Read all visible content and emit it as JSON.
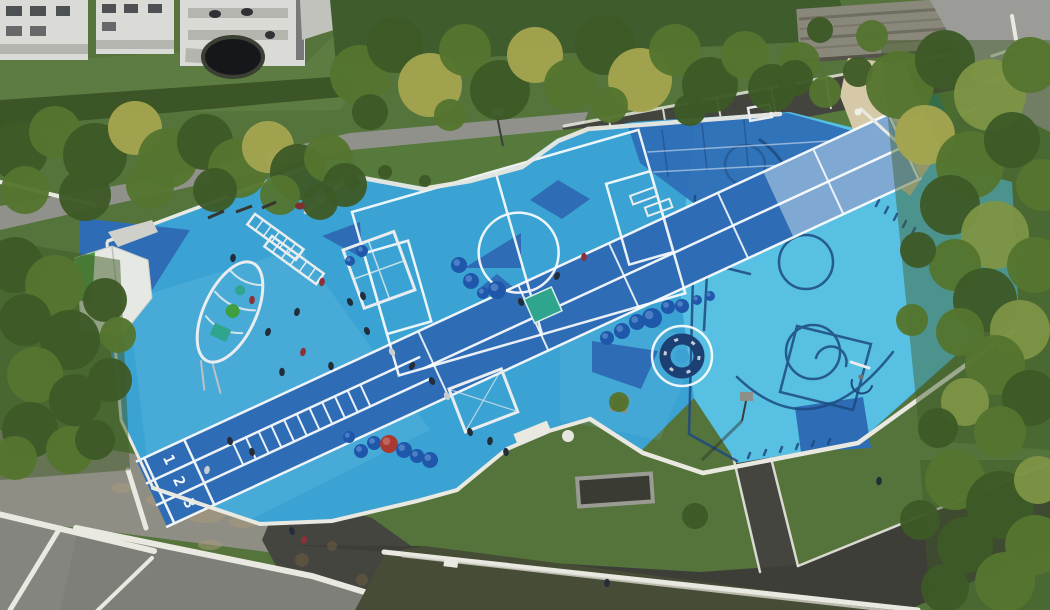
{
  "image": {
    "type": "aerial-drone-photo",
    "subject": "Blue multi-sport playground park seen from above: running track, ball courts, climbing equipment, surrounded by trees, paths and rooftops"
  },
  "palette": {
    "courtBlue": "#3ba3d3",
    "courtCyan": "#58c0e2",
    "lightOverlay": "#72c6e8",
    "royal": "#2e6cb5",
    "navy": "#1d4a80",
    "parapet": "#eae9e1",
    "equip": "#e9edef",
    "grassBase": "#55743c",
    "grassLight": "#5d7c42",
    "grassDark": "#3f5c2c",
    "hedge": "#3b5526",
    "tree_dark": "#3d5a26",
    "tree_mid": "#54752f",
    "tree_light": "#7d9445",
    "tree_yellow": "#a3a44f",
    "path": "#90918a",
    "road": "#9b9c97",
    "parking": "#43443e",
    "asphalt": "#45453f",
    "asphalt2": "#3e3e39",
    "concrete": "#8f8e85",
    "roof": "#84857e",
    "sedum": "#474c36",
    "sand": "#d6c9a8",
    "stone": "#8a887b",
    "dome": "#1f57aa",
    "domeRed": "#a83a33",
    "mat": "#2ea58c",
    "building": "#dadad6",
    "balcony": "#b5b5af",
    "window": "#35383c",
    "people_dark": "#232d3a",
    "people_red": "#8e3038",
    "people_grey": "#c9cdd0",
    "carousel": "#1c3f74",
    "stain": "#ab9a7c",
    "spot": "#6b5b40",
    "trampoline": "#15171a"
  },
  "track": {
    "lane_numbers": [
      "1",
      "2",
      "3"
    ],
    "ladder_x": [
      95,
      109,
      123,
      137,
      151,
      165,
      179,
      193,
      207,
      221,
      235
    ],
    "cross_x": [
      310,
      420,
      520,
      640,
      745
    ]
  },
  "fence": {
    "x1": 104,
    "y1": 234,
    "x2": 572,
    "y2": 150,
    "count": 17
  },
  "parking_stripes": [
    [
      609,
      119,
      614,
      149
    ],
    [
      663,
      109,
      668,
      139
    ],
    [
      717,
      99,
      723,
      129
    ],
    [
      771,
      89,
      777,
      119
    ],
    [
      826,
      79,
      831,
      109
    ],
    [
      880,
      69,
      886,
      98
    ]
  ],
  "trees": [
    [
      18,
      150,
      30,
      "dark"
    ],
    [
      55,
      132,
      26,
      "mid"
    ],
    [
      95,
      155,
      32,
      "dark"
    ],
    [
      135,
      128,
      27,
      "yellow"
    ],
    [
      168,
      158,
      30,
      "mid"
    ],
    [
      205,
      142,
      28,
      "dark"
    ],
    [
      238,
      168,
      30,
      "mid"
    ],
    [
      268,
      147,
      26,
      "yellow"
    ],
    [
      298,
      172,
      28,
      "dark"
    ],
    [
      328,
      158,
      24,
      "mid"
    ],
    [
      345,
      185,
      22,
      "dark"
    ],
    [
      25,
      190,
      24,
      "mid"
    ],
    [
      85,
      195,
      26,
      "dark"
    ],
    [
      150,
      185,
      24,
      "mid"
    ],
    [
      215,
      190,
      22,
      "dark"
    ],
    [
      280,
      195,
      20,
      "mid"
    ],
    [
      320,
      202,
      18,
      "dark"
    ],
    [
      360,
      75,
      30,
      "mid"
    ],
    [
      395,
      45,
      28,
      "dark"
    ],
    [
      430,
      85,
      32,
      "yellow"
    ],
    [
      465,
      50,
      26,
      "mid"
    ],
    [
      500,
      90,
      30,
      "dark"
    ],
    [
      535,
      55,
      28,
      "yellow"
    ],
    [
      570,
      85,
      26,
      "mid"
    ],
    [
      605,
      45,
      30,
      "dark"
    ],
    [
      640,
      80,
      32,
      "yellow"
    ],
    [
      675,
      50,
      26,
      "mid"
    ],
    [
      710,
      85,
      28,
      "dark"
    ],
    [
      745,
      55,
      24,
      "mid"
    ],
    [
      772,
      88,
      24,
      "dark"
    ],
    [
      800,
      62,
      20,
      "mid"
    ],
    [
      370,
      112,
      18,
      "dark"
    ],
    [
      450,
      115,
      16,
      "mid"
    ],
    [
      610,
      105,
      18,
      "mid"
    ],
    [
      690,
      110,
      16,
      "dark"
    ],
    [
      795,
      78,
      18,
      "dark"
    ],
    [
      825,
      92,
      16,
      "mid"
    ],
    [
      858,
      72,
      15,
      "dark"
    ],
    [
      872,
      36,
      16,
      "mid"
    ],
    [
      820,
      30,
      13,
      "dark"
    ],
    [
      900,
      85,
      34,
      "mid"
    ],
    [
      945,
      60,
      30,
      "dark"
    ],
    [
      990,
      95,
      36,
      "light"
    ],
    [
      1030,
      65,
      28,
      "mid"
    ],
    [
      925,
      135,
      30,
      "yellow"
    ],
    [
      970,
      165,
      34,
      "mid"
    ],
    [
      1012,
      140,
      28,
      "dark"
    ],
    [
      1042,
      185,
      26,
      "mid"
    ],
    [
      950,
      205,
      30,
      "dark"
    ],
    [
      995,
      235,
      34,
      "light"
    ],
    [
      1035,
      265,
      28,
      "mid"
    ],
    [
      955,
      265,
      26,
      "mid"
    ],
    [
      985,
      300,
      32,
      "dark"
    ],
    [
      1020,
      330,
      30,
      "light"
    ],
    [
      960,
      332,
      24,
      "mid"
    ],
    [
      995,
      365,
      30,
      "mid"
    ],
    [
      1030,
      398,
      28,
      "dark"
    ],
    [
      965,
      402,
      24,
      "light"
    ],
    [
      1000,
      432,
      26,
      "mid"
    ],
    [
      938,
      428,
      20,
      "dark"
    ],
    [
      918,
      250,
      18,
      "dark"
    ],
    [
      912,
      320,
      16,
      "mid"
    ],
    [
      15,
      265,
      28,
      "dark"
    ],
    [
      55,
      285,
      30,
      "mid"
    ],
    [
      25,
      320,
      26,
      "dark"
    ],
    [
      70,
      340,
      30,
      "dark"
    ],
    [
      35,
      375,
      28,
      "mid"
    ],
    [
      75,
      400,
      26,
      "dark"
    ],
    [
      30,
      430,
      28,
      "dark"
    ],
    [
      70,
      450,
      24,
      "mid"
    ],
    [
      105,
      300,
      22,
      "dark"
    ],
    [
      110,
      380,
      22,
      "dark"
    ],
    [
      95,
      440,
      20,
      "dark"
    ],
    [
      15,
      458,
      22,
      "mid"
    ],
    [
      118,
      335,
      18,
      "mid"
    ],
    [
      955,
      480,
      30,
      "mid"
    ],
    [
      1000,
      505,
      34,
      "dark"
    ],
    [
      1035,
      545,
      30,
      "mid"
    ],
    [
      965,
      545,
      28,
      "dark"
    ],
    [
      1005,
      582,
      30,
      "mid"
    ],
    [
      945,
      588,
      24,
      "dark"
    ],
    [
      1038,
      480,
      24,
      "light"
    ],
    [
      920,
      520,
      20,
      "dark"
    ],
    [
      695,
      516,
      13,
      "dark"
    ],
    [
      619,
      402,
      10,
      "mid"
    ],
    [
      352,
      182,
      8,
      "dark"
    ],
    [
      385,
      172,
      7,
      "dark"
    ],
    [
      425,
      181,
      6,
      "dark"
    ]
  ],
  "domes": [
    [
      459,
      265,
      8
    ],
    [
      471,
      281,
      8
    ],
    [
      483,
      293,
      6
    ],
    [
      497,
      290,
      9
    ],
    [
      362,
      251,
      6
    ],
    [
      350,
      261,
      5
    ],
    [
      349,
      437,
      6
    ],
    [
      361,
      451,
      7
    ],
    [
      374,
      443,
      7
    ],
    [
      389,
      444,
      9,
      "red"
    ],
    [
      404,
      450,
      8
    ],
    [
      417,
      456,
      7
    ],
    [
      430,
      460,
      8
    ],
    [
      607,
      338,
      7
    ],
    [
      622,
      331,
      8
    ],
    [
      637,
      322,
      8
    ],
    [
      652,
      318,
      10
    ],
    [
      668,
      307,
      7
    ],
    [
      682,
      306,
      7
    ],
    [
      697,
      300,
      5
    ],
    [
      710,
      296,
      5
    ]
  ],
  "people": [
    [
      233,
      258,
      "dark"
    ],
    [
      252,
      300,
      "red"
    ],
    [
      268,
      332,
      "dark"
    ],
    [
      297,
      312,
      "dark"
    ],
    [
      322,
      282,
      "red"
    ],
    [
      350,
      302,
      "dark"
    ],
    [
      367,
      331,
      "dark"
    ],
    [
      392,
      352,
      "grey"
    ],
    [
      412,
      366,
      "dark"
    ],
    [
      303,
      352,
      "red"
    ],
    [
      282,
      372,
      "dark"
    ],
    [
      331,
      366,
      "dark"
    ],
    [
      432,
      381,
      "dark"
    ],
    [
      447,
      396,
      "grey"
    ],
    [
      521,
      302,
      "dark"
    ],
    [
      557,
      276,
      "dark"
    ],
    [
      584,
      257,
      "red"
    ],
    [
      363,
      296,
      "dark"
    ],
    [
      230,
      441,
      "dark"
    ],
    [
      252,
      452,
      "dark"
    ],
    [
      207,
      470,
      "grey"
    ],
    [
      292,
      531,
      "dark"
    ],
    [
      304,
      540,
      "red"
    ],
    [
      470,
      432,
      "dark"
    ],
    [
      490,
      441,
      "dark"
    ],
    [
      506,
      452,
      "dark"
    ],
    [
      879,
      481,
      "dark"
    ],
    [
      607,
      583,
      "dark"
    ]
  ],
  "stains": [
    [
      162,
      500,
      16,
      7
    ],
    [
      205,
      515,
      20,
      8
    ],
    [
      243,
      522,
      14,
      6
    ],
    [
      122,
      488,
      10,
      5
    ],
    [
      185,
      472,
      8,
      4
    ],
    [
      210,
      545,
      12,
      5
    ]
  ],
  "spots": [
    [
      12,
      540,
      6
    ],
    [
      30,
      568,
      5
    ],
    [
      44,
      594,
      6
    ],
    [
      302,
      560,
      7
    ],
    [
      332,
      546,
      5
    ],
    [
      362,
      580,
      6
    ],
    [
      412,
      590,
      5
    ],
    [
      312,
      600,
      6
    ],
    [
      286,
      520,
      4
    ]
  ]
}
